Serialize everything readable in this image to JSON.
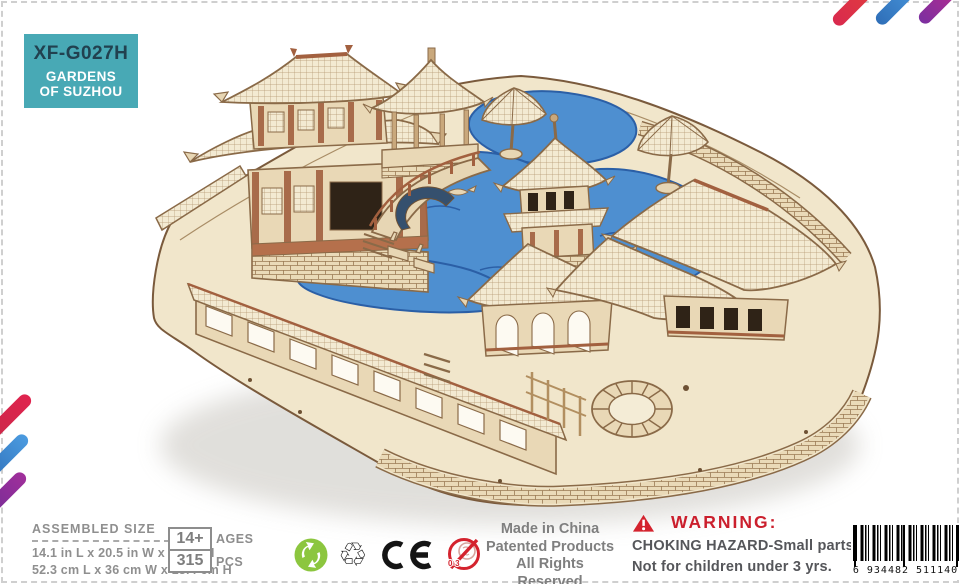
{
  "package": {
    "model_code": "XF-G027H",
    "series_line1": "GARDENS",
    "series_line2": "OF SUZHOU"
  },
  "specs": {
    "heading": "ASSEMBLED SIZE",
    "size_inches": "14.1 in L x 20.5 in W x 5.2 in H",
    "size_cm": "52.3 cm L x 36 cm W x 13.4 cm H",
    "age_value": "14+",
    "age_label": "AGES",
    "pieces_value": "315",
    "pieces_label": "PCS"
  },
  "compliance": {
    "choking_icon_text": "0-3",
    "made_in": "Made in China",
    "patented": "Patented Products",
    "rights": "All Rights Reserved"
  },
  "warning": {
    "title": "WARNING:",
    "hazard": "CHOKING HAZARD-Small parts.",
    "age_note": "Not for children under 3 yrs."
  },
  "barcode": {
    "number": "6 934482 511140"
  },
  "colors": {
    "badge_teal": "#48A9B5",
    "badge_text_dark": "#21414F",
    "stripe_red": "#DC2850",
    "stripe_blue": "#3E8CCF",
    "stripe_purple": "#8A2D9E",
    "warning_red": "#CB1F2D",
    "water_blue": "#4E8FD0",
    "wood_light": "#F1E6CB",
    "wood_outline": "#8A6A48"
  }
}
